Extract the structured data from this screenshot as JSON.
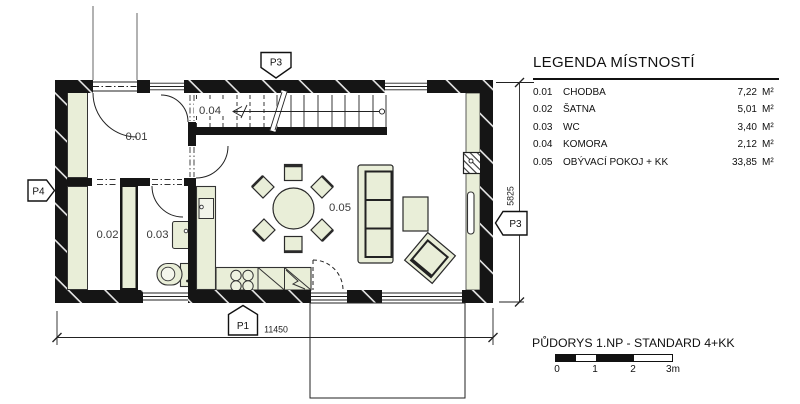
{
  "legend": {
    "title": "LEGENDA MÍSTNOSTÍ",
    "rows": [
      {
        "num": "0.01",
        "name": "CHODBA",
        "area": "7,22",
        "unit": "M²"
      },
      {
        "num": "0.02",
        "name": "ŠATNA",
        "area": "5,01",
        "unit": "M²"
      },
      {
        "num": "0.03",
        "name": "WC",
        "area": "3,40",
        "unit": "M²"
      },
      {
        "num": "0.04",
        "name": "KOMORA",
        "area": "2,12",
        "unit": "M²"
      },
      {
        "num": "0.05",
        "name": "OBÝVACÍ POKOJ + KK",
        "area": "33,85",
        "unit": "M²"
      }
    ]
  },
  "plan": {
    "room_labels": {
      "r001": "0.01",
      "r002": "0.02",
      "r003": "0.03",
      "r004": "0.04",
      "r005": "0.05"
    },
    "markers": {
      "top": "P3",
      "right": "P3",
      "left": "P4",
      "bottom": "P1"
    },
    "dimensions": {
      "width": "11450",
      "height": "5825"
    }
  },
  "titleblock": {
    "title": "PŮDORYS 1.NP - STANDARD 4+KK",
    "scale_labels": [
      "0",
      "1",
      "2",
      "3m"
    ]
  },
  "colors": {
    "line": "#1a1a1a",
    "wall": "#151515",
    "furniture_fill": "#e9eed8",
    "background": "#ffffff"
  }
}
